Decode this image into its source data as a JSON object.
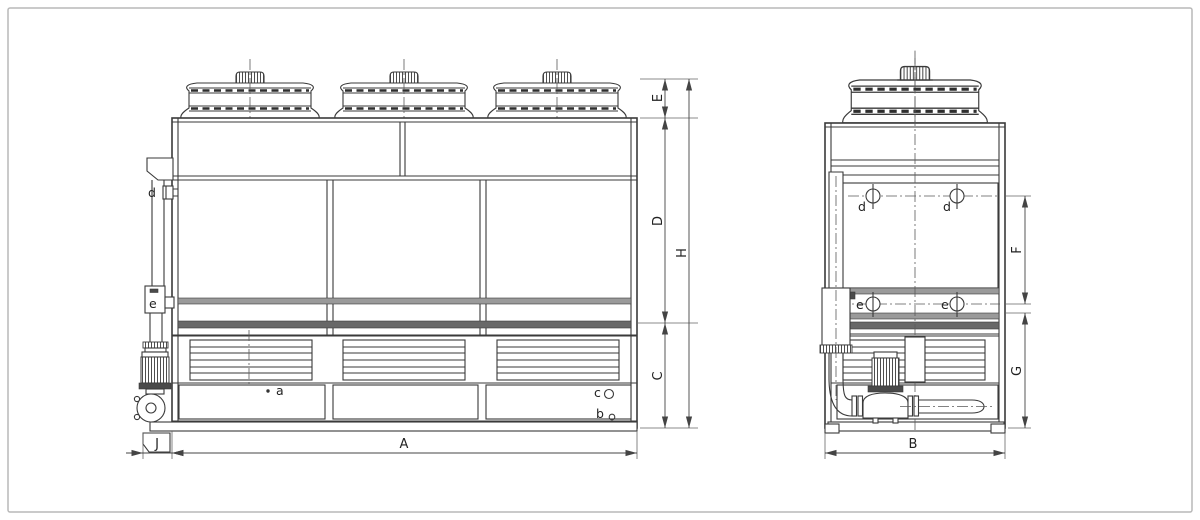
{
  "drawing": {
    "front_view": {
      "dimension_labels": {
        "overall_width": "A",
        "pump_overhang": "J",
        "basin_section_height": "C",
        "casing_section_height": "D",
        "fan_section_height": "E",
        "overall_height": "H"
      },
      "connection_labels": {
        "a": "a",
        "b": "b",
        "c": "c",
        "d": "d",
        "e": "e"
      }
    },
    "side_view": {
      "dimension_labels": {
        "overall_width": "B",
        "upper_connection_span": "F",
        "lower_connection_span": "G"
      },
      "connection_labels": {
        "d_left": "d",
        "d_right": "d",
        "e_left": "e",
        "e_right": "e"
      }
    },
    "colors": {
      "line": "#3a3a3a",
      "band_light": "#9a9a9a",
      "band_dark": "#686868",
      "page_border": "#b8b8b8",
      "background": "#ffffff"
    }
  }
}
